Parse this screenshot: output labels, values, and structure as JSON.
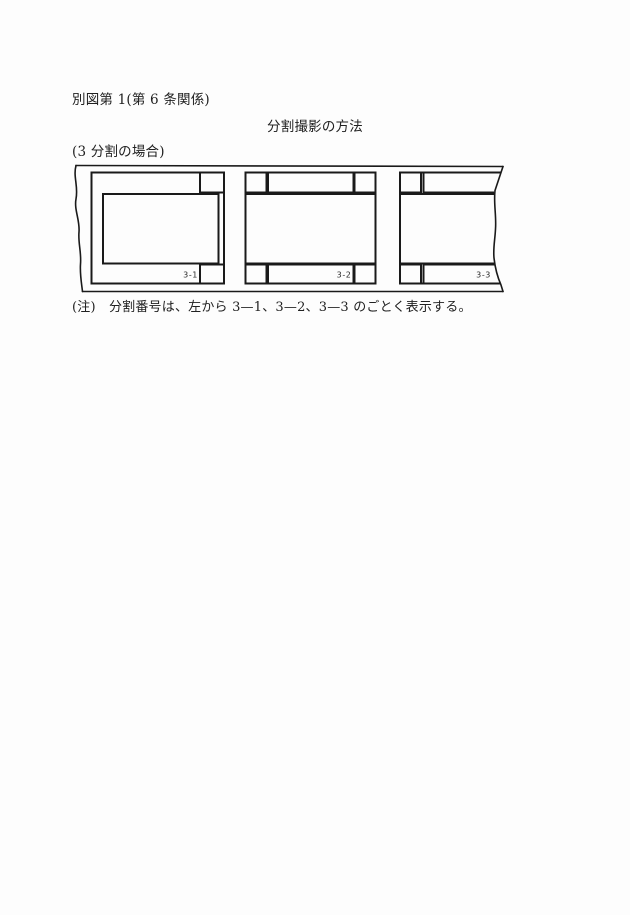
{
  "document": {
    "figure_label": "別図第 1(第 6 条関係)",
    "title": "分割撮影の方法",
    "case_label": "(3 分割の場合)",
    "note": "(注)　分割番号は、左から 3—1、3—2、3—3 のごとく表示する。"
  },
  "diagram": {
    "type": "film-strip",
    "line_color": "#1a1a1a",
    "frames": [
      {
        "label": "3-1"
      },
      {
        "label": "3-2"
      },
      {
        "label": "3-3"
      }
    ]
  }
}
